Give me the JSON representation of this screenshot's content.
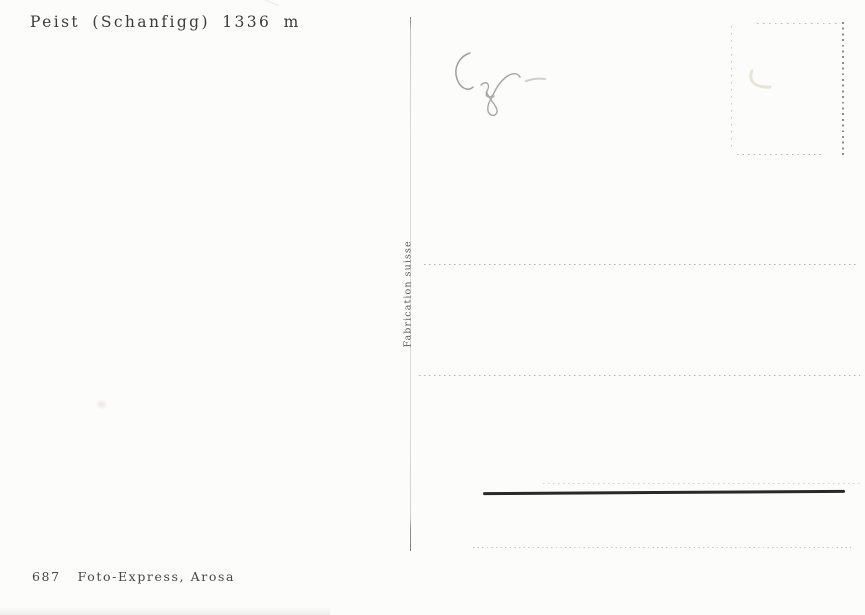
{
  "card": {
    "caption": "Peist (Schanfigg) 1336 m",
    "imprint": {
      "number": "687",
      "publisher": "Foto-Express, Arosa"
    },
    "side_label": "Fabrication suisse"
  },
  "colors": {
    "paper": "#fcfcfa",
    "printed_ink": "#3c3c3c",
    "imprint_ink": "#474747",
    "side_label_ink": "#5c5c5c",
    "dotted_line": "#b4b4b4",
    "stamp_box_dots": "#8d8d8d",
    "drawn_solid_line": "#292929",
    "pencil_mark": "#9f9f9f"
  }
}
